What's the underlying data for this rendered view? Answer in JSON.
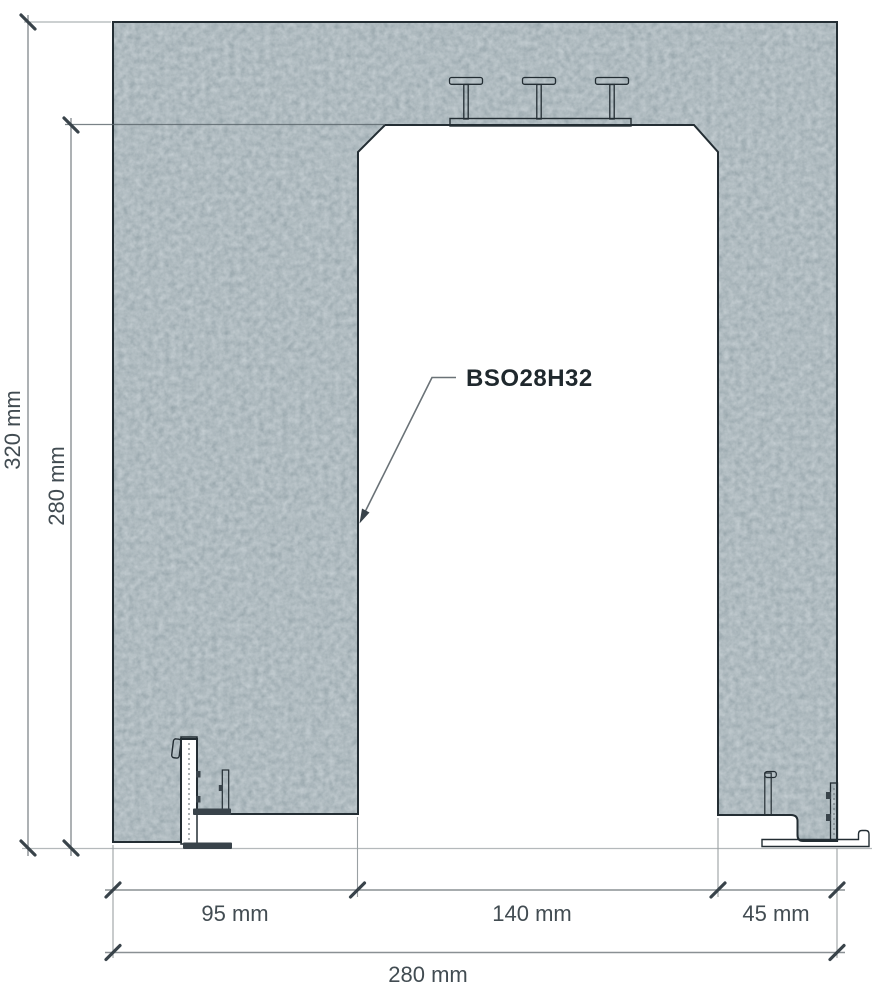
{
  "drawing": {
    "callout": {
      "label": "BSO28H32"
    },
    "dimensions": {
      "total_height": "320 mm",
      "inner_height": "280 mm",
      "left_wall_width": "95 mm",
      "opening_width": "140 mm",
      "right_wall_width": "45 mm",
      "total_width": "280 mm"
    },
    "elements": {
      "concrete_section": "speckled concrete portal with chamfered opening corners",
      "steel_beams": "three T-profile beams on a flat plate at lintel soffit",
      "left_edge_profile": "white edge channel with hook, anchor tabs and base foot",
      "right_edge_profile": "stepped edge profile with anchor rail and base plate"
    },
    "colors": {
      "concrete_base": "#6d7a81",
      "concrete_dark": "#47525a",
      "concrete_light": "#93a2a8",
      "outline": "#232d33",
      "dimension_line": "#8a9094",
      "extension_line": "#9aa0a3",
      "tick": "#39434a",
      "dim_text": "#424c52",
      "callout_text": "#1f282d",
      "ground_line": "#b4b9bb",
      "steel_fill": "#c9cfd2",
      "plate_fill": "#828d92",
      "profile_dark": "#39434a"
    }
  }
}
